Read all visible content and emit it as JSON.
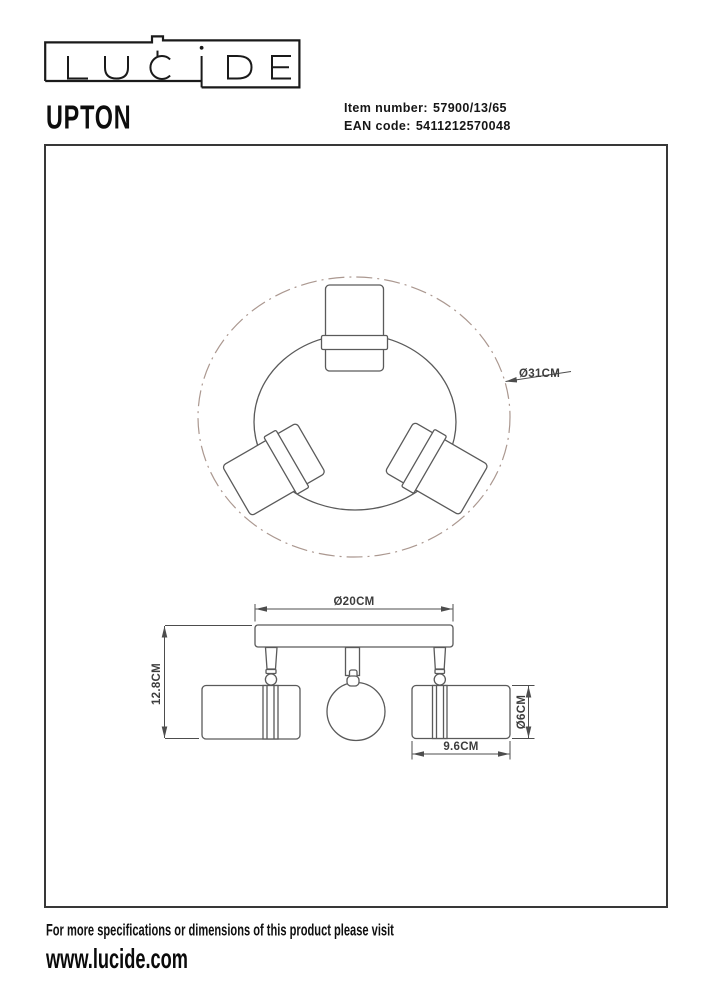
{
  "brand": {
    "name": "LUCIDE"
  },
  "product": {
    "name": "UPTON",
    "item_number_label": "Item number:",
    "item_number": "57900/13/65",
    "ean_label": "EAN code:",
    "ean": "5411212570048"
  },
  "drawing": {
    "dimension_labels": {
      "outer_diameter": "Ø31CM",
      "base_diameter": "Ø20CM",
      "height": "12.8CM",
      "spot_diameter": "Ø6CM",
      "spot_length": "9.6CM"
    },
    "dimension_values_cm": {
      "outer_diameter": 31,
      "base_diameter": 20,
      "height": 12.8,
      "spot_diameter": 6,
      "spot_length": 9.6
    }
  },
  "footer": {
    "note": "For more specifications or dimensions of this product please visit",
    "website": "www.lucide.com"
  },
  "colors": {
    "line": "#5a5a5a",
    "dash_line": "#ab9890",
    "frame": "#383838",
    "text": "#1a1a1a"
  }
}
